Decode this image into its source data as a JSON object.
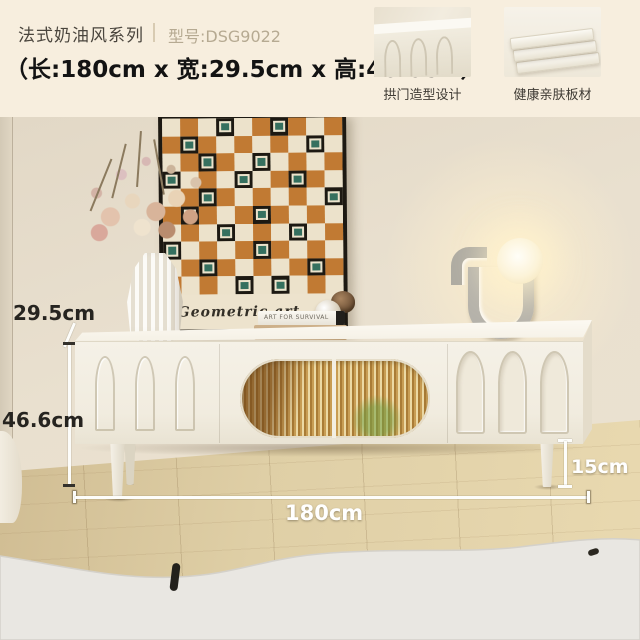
{
  "header": {
    "series_title": "法式奶油风系列",
    "model_label": "型号:DSG9022",
    "size_line": "（长:180cm x 宽:29.5cm x 高:46.6cm）",
    "features": [
      {
        "label": "拱门造型设计"
      },
      {
        "label": "健康亲肤板材"
      }
    ]
  },
  "scene": {
    "annotations": {
      "depth_label": "29.5cm",
      "height_label": "46.6cm",
      "length_label": "180cm",
      "leg_height_label": "15cm"
    },
    "art_print": {
      "caption": "Geometric art",
      "grid": {
        "rows": 10,
        "cols": 10,
        "teal_cells": [
          [
            0,
            3
          ],
          [
            0,
            6
          ],
          [
            1,
            1
          ],
          [
            1,
            8
          ],
          [
            2,
            2
          ],
          [
            2,
            5
          ],
          [
            3,
            0
          ],
          [
            3,
            4
          ],
          [
            3,
            7
          ],
          [
            4,
            2
          ],
          [
            4,
            9
          ],
          [
            5,
            1
          ],
          [
            5,
            5
          ],
          [
            6,
            3
          ],
          [
            6,
            7
          ],
          [
            7,
            0
          ],
          [
            7,
            5
          ],
          [
            8,
            2
          ],
          [
            8,
            8
          ],
          [
            9,
            4
          ],
          [
            9,
            6
          ]
        ]
      },
      "colors": {
        "orange": "#c17a33",
        "cream": "#ece2cb",
        "teal": "#35705f",
        "frame_black": "#1d1912"
      }
    },
    "books": {
      "top_spine": "ART FOR SURVIVAL",
      "bottom_spine": "ONE LINE A DAY"
    }
  },
  "palette": {
    "header_bg": "#f7eede",
    "wall": "#e8dfcf",
    "cabinet": "#f3efe4",
    "floor": "#ddcba3",
    "rug": "#e9e7e2",
    "glass_amber": "#c79a54",
    "annotation_white": "#ffffff",
    "annotation_dark": "#262420"
  }
}
